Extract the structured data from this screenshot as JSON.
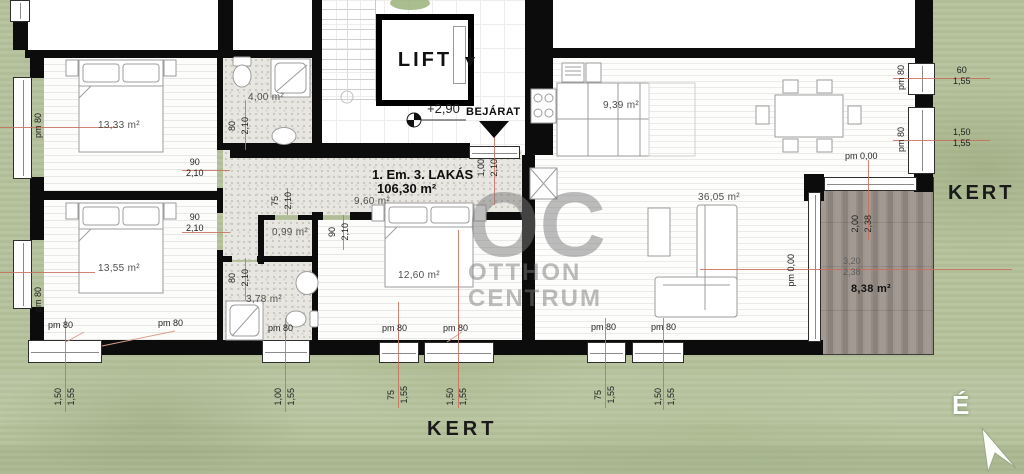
{
  "floorplan": {
    "title": {
      "line1": "1. Em. 3. LAKÁS",
      "line2": "106,30 m²"
    },
    "lift_label": "LIFT",
    "entrance": {
      "level": "+2,90",
      "label": "BEJÁRAT"
    },
    "garden": {
      "right": "KERT",
      "bottom": "KERT"
    },
    "compass_north": "É",
    "watermark": {
      "logo": "OC",
      "line1": "OTTHON",
      "line2": "CENTRUM"
    },
    "rooms": {
      "bedroom1": {
        "area": "13,33 m²"
      },
      "bedroom2": {
        "area": "13,55 m²"
      },
      "bedroom3": {
        "area": "12,60 m²"
      },
      "bathroom1": {
        "area": "4,00 m²"
      },
      "bathroom2": {
        "area": "3,78 m²"
      },
      "closet": {
        "area": "0,99 m²"
      },
      "hall": {
        "area": "9,60 m²"
      },
      "kitchen": {
        "area": "9,39 m²"
      },
      "living": {
        "area": "36,05 m²"
      },
      "terrace": {
        "area": "8,38 m²"
      }
    },
    "dims": {
      "parapet80": "pm 80",
      "parapet0": "pm 0,00",
      "w90": "90",
      "w80": "80",
      "w75": "75",
      "w60": "60",
      "h210": "2,10",
      "h155": "1,55",
      "l150": "1,50",
      "l100": "1,00",
      "l200": "2,00",
      "l238": "2,38",
      "l320": "3,20"
    }
  }
}
